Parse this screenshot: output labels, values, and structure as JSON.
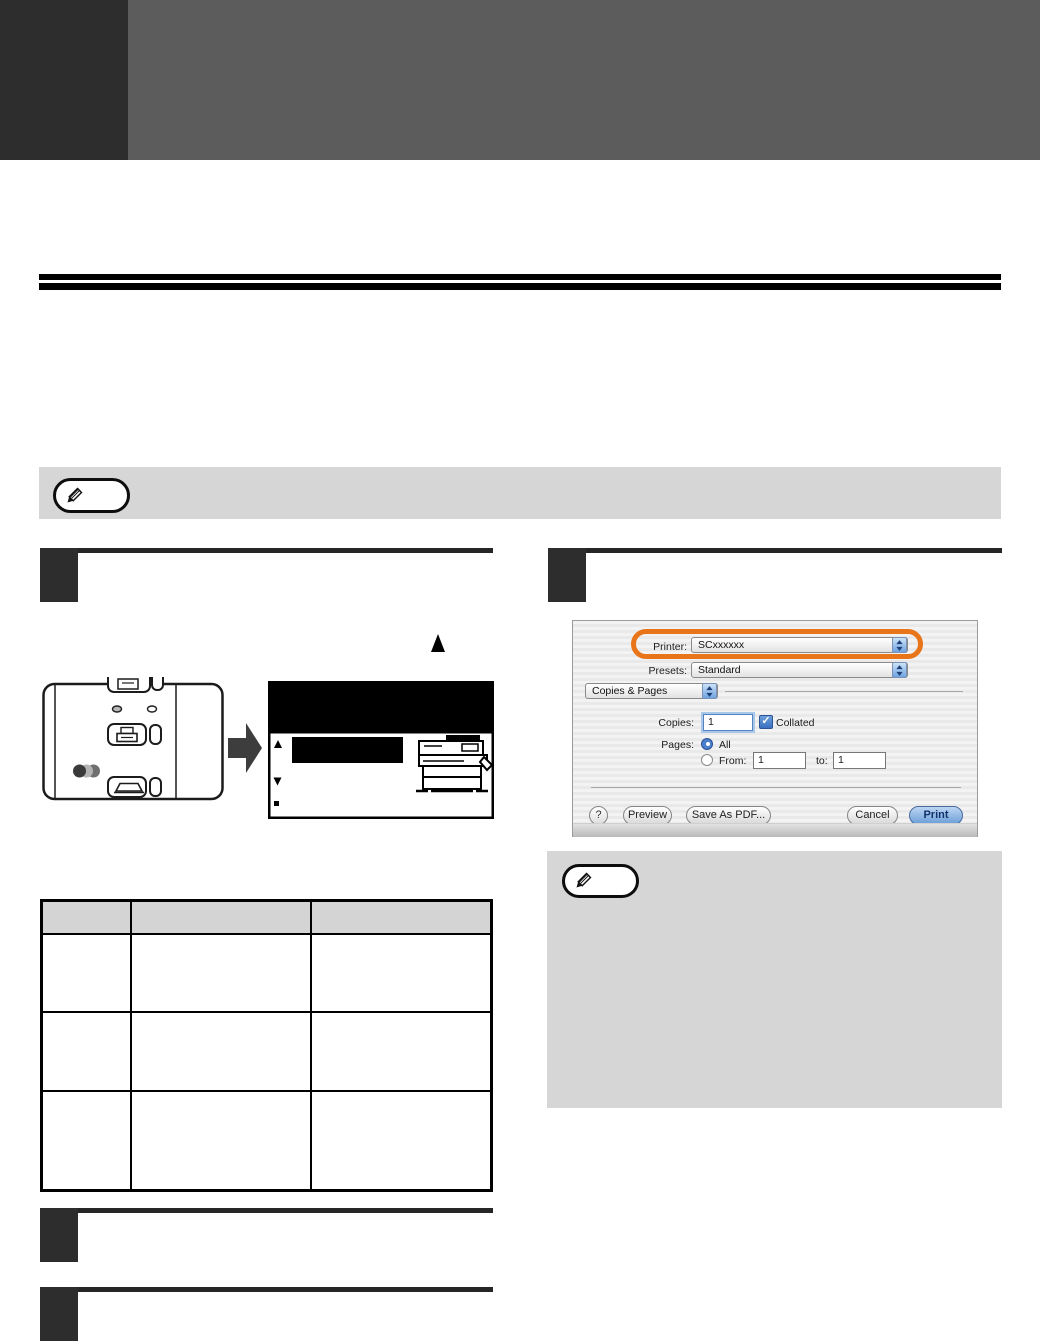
{
  "dialog": {
    "printer_label": "Printer:",
    "printer_value": "SCxxxxxx",
    "presets_label": "Presets:",
    "presets_value": "Standard",
    "pane_value": "Copies & Pages",
    "copies_label": "Copies:",
    "copies_value": "1",
    "collated_label": "Collated",
    "checkmark": "✓",
    "pages_label": "Pages:",
    "all_label": "All",
    "from_label": "From:",
    "from_value": "1",
    "to_label": "to:",
    "to_value": "1",
    "help_label": "?",
    "preview_label": "Preview",
    "save_pdf_label": "Save As PDF...",
    "cancel_label": "Cancel",
    "print_label": "Print"
  },
  "table": {
    "header": [
      "",
      "",
      ""
    ],
    "rows": [
      [
        "",
        "",
        ""
      ],
      [
        "",
        "",
        ""
      ],
      [
        "",
        "",
        ""
      ]
    ]
  },
  "icons": {
    "note_badge": "pencil-icon",
    "flow_arrow": "right-arrow-icon",
    "above_display": "up-triangle-icon",
    "lcd_cursor_up": "up-triangle-icon",
    "lcd_cursor_down": "down-triangle-icon"
  },
  "colors": {
    "highlight_ring": "#E8751A",
    "header_block": "#2D2D2D",
    "header_band": "#5C5C5C",
    "note_bg": "#D6D6D6",
    "step_box": "#2D2D2D",
    "table_header_bg": "#D4D4D4",
    "print_button_blue": "#8AB4EA"
  }
}
